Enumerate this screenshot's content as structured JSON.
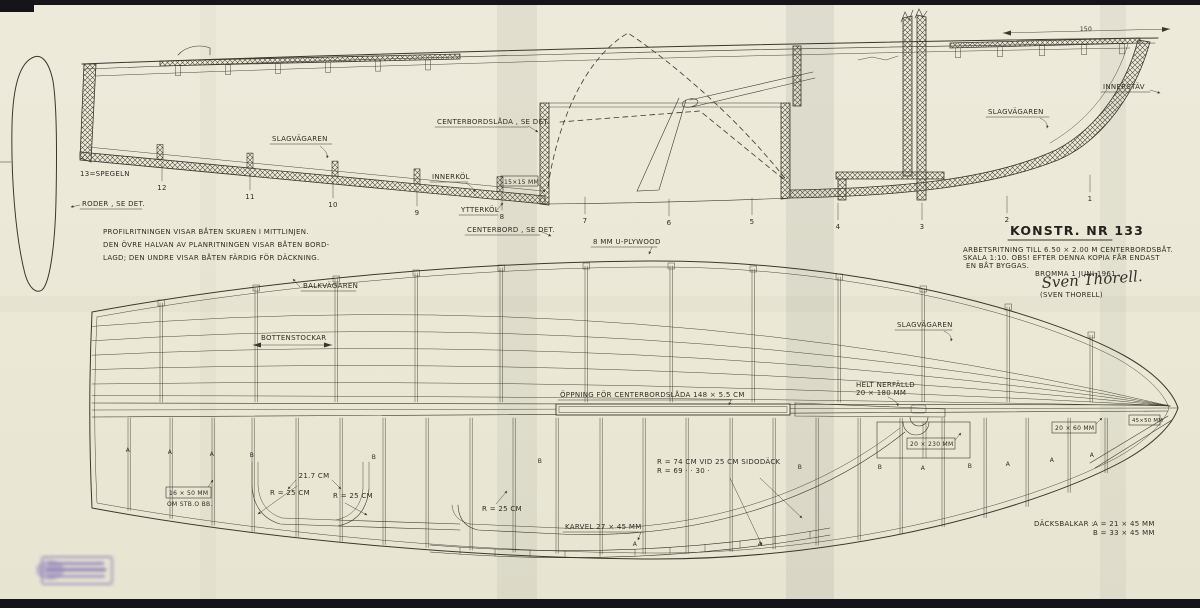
{
  "colors": {
    "paper": "#ebe8d6",
    "ink": "#3a382d",
    "stamp": "#7a6cb4"
  },
  "notes": {
    "line1": "PROFILRITNINGEN VISAR BÅTEN SKUREN I MITTLINJEN.",
    "line2": "DEN ÖVRE HALVAN AV PLANRITNINGEN VISAR BÅTEN BORD-",
    "line3": "LAGD; DEN UNDRE VISAR BÅTEN FÄRDIG FÖR DÄCKNING."
  },
  "title_block": {
    "title": "KONSTR. NR 133",
    "line1": "ARBETSRITNING TILL  6.50 × 2.00 M  CENTERBORDSBÅT.",
    "line2": "SKALA 1:10.  OBS!  EFTER DENNA KOPIA FÅR ENDAST",
    "line3": "EN BÅT BYGGAS.",
    "date": "BROMMA 1 JUNI 1961.",
    "signature": "Sven Thorell.",
    "signature_printed": "(SVEN THORELL)"
  },
  "profile": {
    "stations": [
      "12",
      "11",
      "10",
      "9",
      "8",
      "7",
      "6",
      "5",
      "4",
      "3",
      "2",
      "1"
    ],
    "labels": {
      "spegeln": "13=SPEGELN",
      "roder": "RODER , SE DET.",
      "slagvagaren_aft": "SLAGVÄGAREN",
      "centerbordslada": "CENTERBORDSLÅDA , SE DET.",
      "innerkol": "INNERKÖL",
      "keel_dim": "15×15 MM",
      "ytterkol": "YTTERKÖL",
      "centerbord": "CENTERBORD , SE DET.",
      "plywood": "8 MM U-PLYWOOD",
      "slagvagaren_fwd": "SLAGVÄGAREN",
      "innerstav": "INNERSTÄV",
      "mast_dim": "150"
    }
  },
  "plan": {
    "labels": {
      "balkvagaren": "BALKVÄGAREN",
      "bottenstockar": "BOTTENSTOCKAR",
      "slagvagaren": "SLAGVÄGAREN",
      "oppning": "ÖPPNING  FÖR  CENTERBORDSLÅDA   148 × 5.5 CM",
      "helt_nerfalld_line1": "HELT NERFÄLLD",
      "helt_nerfalld_line2": "20 × 180 MM",
      "radius_line1": "R = 74 CM VID 25 CM SIDODÄCK",
      "radius_line2": "R = 69   ·      ·    30   ·",
      "dim_217": "21.7 CM",
      "r25": "R = 25 CM",
      "karvel": "KARVEL  27 × 45 MM",
      "stod_line1": "16 × 50 MM",
      "stod_line2": "OM STB.O BB.",
      "dim_20x230": "20 × 230 MM",
      "dim_20x60": "20 × 60 MM",
      "dim_45x50": "45×50 MM"
    },
    "dacksbalkar": {
      "label": "DÄCKSBALKAR :",
      "a": "A  =  21 × 45 MM",
      "b": "B  =  33 × 45 MM"
    },
    "deck_beam_letters": [
      "A",
      "A",
      "A",
      "B",
      "B",
      "B",
      "B",
      "B",
      "A",
      "B",
      "A",
      "A",
      "A",
      "A",
      "A"
    ]
  }
}
